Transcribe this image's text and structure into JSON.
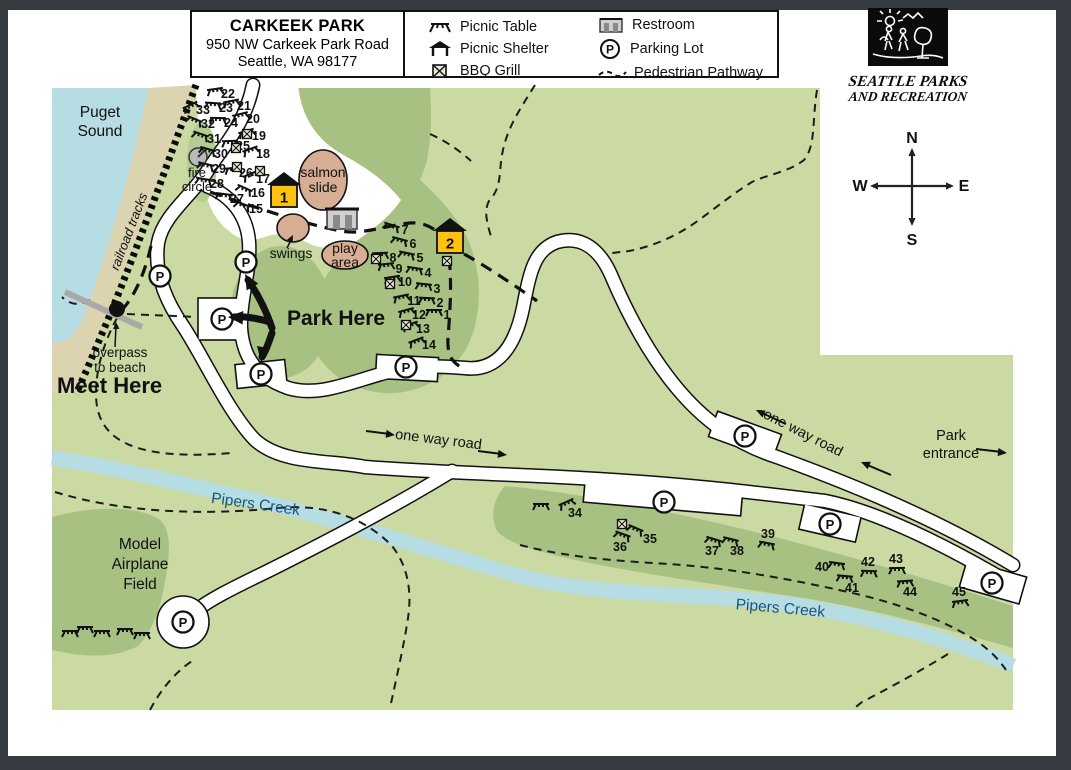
{
  "title_box": {
    "title": "CARKEEK PARK",
    "address1": "950 NW Carkeek Park Road",
    "address2": "Seattle, WA 98177"
  },
  "legend": {
    "items": [
      {
        "icon": "picnic-table-icon",
        "label": "Picnic Table"
      },
      {
        "icon": "picnic-shelter-icon",
        "label": "Picnic Shelter"
      },
      {
        "icon": "bbq-grill-icon",
        "label": "BBQ Grill"
      },
      {
        "icon": "restroom-icon",
        "label": "Restroom"
      },
      {
        "icon": "parking-lot-icon",
        "label": "Parking Lot"
      },
      {
        "icon": "pedestrian-pathway-icon",
        "label": "Pedestrian Pathway"
      }
    ]
  },
  "logo": {
    "line1": "SEATTLE PARKS",
    "line2": "AND RECREATION"
  },
  "compass": {
    "n": "N",
    "e": "E",
    "s": "S",
    "w": "W"
  },
  "map": {
    "colors": {
      "base": "#cbd9a3",
      "dark": "#a6c182",
      "mound": "#b4cc90",
      "water": "#b6dce4",
      "beach": "#dcd3b0",
      "tan": "#d7ae93",
      "shelter_yellow": "#ffc20e",
      "road": "#ffffff",
      "outline": "#111111",
      "blue_text": "#1a567c"
    },
    "labels": [
      {
        "id": "puget-sound",
        "lines": [
          "Puget",
          "Sound"
        ],
        "x": 100,
        "y": 117,
        "size": 15.5,
        "lh": 19
      },
      {
        "id": "railroad-tracks",
        "lines": [
          "railroad tracks"
        ],
        "x": 133,
        "y": 233,
        "size": 13,
        "rot": -69,
        "italic": true
      },
      {
        "id": "fire-circle",
        "lines": [
          "fire",
          "circle"
        ],
        "x": 197,
        "y": 177,
        "size": 13,
        "lh": 14
      },
      {
        "id": "salmon-slide",
        "lines": [
          "salmon",
          "slide"
        ],
        "x": 323,
        "y": 177,
        "size": 14,
        "lh": 15
      },
      {
        "id": "swings",
        "lines": [
          "swings"
        ],
        "x": 291,
        "y": 258,
        "size": 14
      },
      {
        "id": "play-area",
        "lines": [
          "play",
          "area"
        ],
        "x": 345,
        "y": 253,
        "size": 14,
        "lh": 14
      },
      {
        "id": "park-here",
        "lines": [
          "Park Here"
        ],
        "x": 287,
        "y": 325,
        "size": 21,
        "bold": true,
        "anchor": "start"
      },
      {
        "id": "meet-here",
        "lines": [
          "Meet Here"
        ],
        "x": 57,
        "y": 393,
        "size": 22,
        "bold": true,
        "anchor": "start"
      },
      {
        "id": "overpass",
        "lines": [
          "overpass",
          "to beach"
        ],
        "x": 120,
        "y": 357,
        "size": 13.5,
        "lh": 15
      },
      {
        "id": "one-way-road-1",
        "lines": [
          "one way road"
        ],
        "x": 438,
        "y": 444,
        "size": 14.5,
        "rot": 7
      },
      {
        "id": "one-way-road-2",
        "lines": [
          "one way road"
        ],
        "x": 801,
        "y": 437,
        "size": 14.5,
        "rot": 27
      },
      {
        "id": "park-entrance",
        "lines": [
          "Park",
          "entrance"
        ],
        "x": 951,
        "y": 440,
        "size": 14.5,
        "lh": 18
      },
      {
        "id": "pipers-creek-1",
        "lines": [
          "Pipers Creek"
        ],
        "x": 255,
        "y": 509,
        "size": 15.5,
        "rot": 8,
        "color": "#1a567c"
      },
      {
        "id": "pipers-creek-2",
        "lines": [
          "Pipers Creek"
        ],
        "x": 780,
        "y": 613,
        "size": 15.5,
        "rot": 5,
        "color": "#1a567c"
      },
      {
        "id": "model-airplane-field",
        "lines": [
          "Model",
          "Airplane",
          "Field"
        ],
        "x": 140,
        "y": 549,
        "size": 15.5,
        "lh": 20
      }
    ],
    "shelters": [
      {
        "num": "1",
        "x": 284,
        "y": 196
      },
      {
        "num": "2",
        "x": 450,
        "y": 242
      }
    ],
    "picnic_sites": [
      {
        "n": "33",
        "x": 203,
        "y": 110
      },
      {
        "n": "32",
        "x": 208,
        "y": 124
      },
      {
        "n": "31",
        "x": 214,
        "y": 139
      },
      {
        "n": "30",
        "x": 221,
        "y": 154
      },
      {
        "n": "29",
        "x": 219,
        "y": 169
      },
      {
        "n": "28",
        "x": 217,
        "y": 184
      },
      {
        "n": "27",
        "x": 237,
        "y": 199
      },
      {
        "n": "23",
        "x": 226,
        "y": 108
      },
      {
        "n": "24",
        "x": 231,
        "y": 123
      },
      {
        "n": "25",
        "x": 243,
        "y": 146
      },
      {
        "n": "26",
        "x": 246,
        "y": 173
      },
      {
        "n": "22",
        "x": 228,
        "y": 94
      },
      {
        "n": "21",
        "x": 244,
        "y": 106
      },
      {
        "n": "20",
        "x": 253,
        "y": 119
      },
      {
        "n": "19",
        "x": 259,
        "y": 136
      },
      {
        "n": "18",
        "x": 263,
        "y": 154
      },
      {
        "n": "17",
        "x": 263,
        "y": 179
      },
      {
        "n": "16",
        "x": 258,
        "y": 193
      },
      {
        "n": "15",
        "x": 256,
        "y": 209
      },
      {
        "n": "7",
        "x": 405,
        "y": 230
      },
      {
        "n": "6",
        "x": 413,
        "y": 244
      },
      {
        "n": "5",
        "x": 420,
        "y": 258
      },
      {
        "n": "4",
        "x": 428,
        "y": 273
      },
      {
        "n": "3",
        "x": 437,
        "y": 289
      },
      {
        "n": "2",
        "x": 440,
        "y": 303
      },
      {
        "n": "1",
        "x": 447,
        "y": 315
      },
      {
        "n": "8",
        "x": 393,
        "y": 258
      },
      {
        "n": "9",
        "x": 399,
        "y": 269
      },
      {
        "n": "10",
        "x": 405,
        "y": 282
      },
      {
        "n": "11",
        "x": 414,
        "y": 301
      },
      {
        "n": "12",
        "x": 419,
        "y": 315
      },
      {
        "n": "13",
        "x": 423,
        "y": 329
      },
      {
        "n": "14",
        "x": 429,
        "y": 345
      },
      {
        "n": "34",
        "x": 575,
        "y": 513,
        "tx": 566,
        "ty": 502
      },
      {
        "n": "35",
        "x": 650,
        "y": 539,
        "tx": 636,
        "ty": 528
      },
      {
        "n": "36",
        "x": 620,
        "y": 547,
        "tx": 623,
        "ty": 534
      },
      {
        "n": "37",
        "x": 712,
        "y": 551,
        "tx": 714,
        "ty": 539
      },
      {
        "n": "38",
        "x": 737,
        "y": 551,
        "tx": 731,
        "ty": 539
      },
      {
        "n": "39",
        "x": 768,
        "y": 534,
        "tx": 767,
        "ty": 543
      },
      {
        "n": "40",
        "x": 822,
        "y": 567,
        "tx": 837,
        "ty": 563
      },
      {
        "n": "41",
        "x": 852,
        "y": 588,
        "tx": 845,
        "ty": 576
      },
      {
        "n": "42",
        "x": 868,
        "y": 562,
        "tx": 869,
        "ty": 571
      },
      {
        "n": "43",
        "x": 896,
        "y": 559,
        "tx": 897,
        "ty": 568
      },
      {
        "n": "44",
        "x": 910,
        "y": 592,
        "tx": 905,
        "ty": 581
      },
      {
        "n": "45",
        "x": 959,
        "y": 592,
        "tx": 960,
        "ty": 601
      }
    ],
    "table_icons": [
      {
        "x": 541,
        "y": 504
      },
      {
        "x": 70,
        "y": 631
      },
      {
        "x": 85,
        "y": 627
      },
      {
        "x": 102,
        "y": 631
      },
      {
        "x": 125,
        "y": 629
      },
      {
        "x": 142,
        "y": 633
      }
    ],
    "grills": [
      {
        "x": 247,
        "y": 134
      },
      {
        "x": 236,
        "y": 148
      },
      {
        "x": 237,
        "y": 167
      },
      {
        "x": 260,
        "y": 171
      },
      {
        "x": 376,
        "y": 259
      },
      {
        "x": 390,
        "y": 284
      },
      {
        "x": 406,
        "y": 325
      },
      {
        "x": 447,
        "y": 261
      },
      {
        "x": 622,
        "y": 524
      }
    ],
    "parking": [
      {
        "x": 160,
        "y": 276
      },
      {
        "x": 246,
        "y": 262
      },
      {
        "x": 222,
        "y": 319
      },
      {
        "x": 261,
        "y": 374
      },
      {
        "x": 406,
        "y": 367
      },
      {
        "x": 745,
        "y": 436
      },
      {
        "x": 664,
        "y": 502
      },
      {
        "x": 830,
        "y": 524
      },
      {
        "x": 992,
        "y": 583
      },
      {
        "x": 183,
        "y": 622
      }
    ]
  }
}
